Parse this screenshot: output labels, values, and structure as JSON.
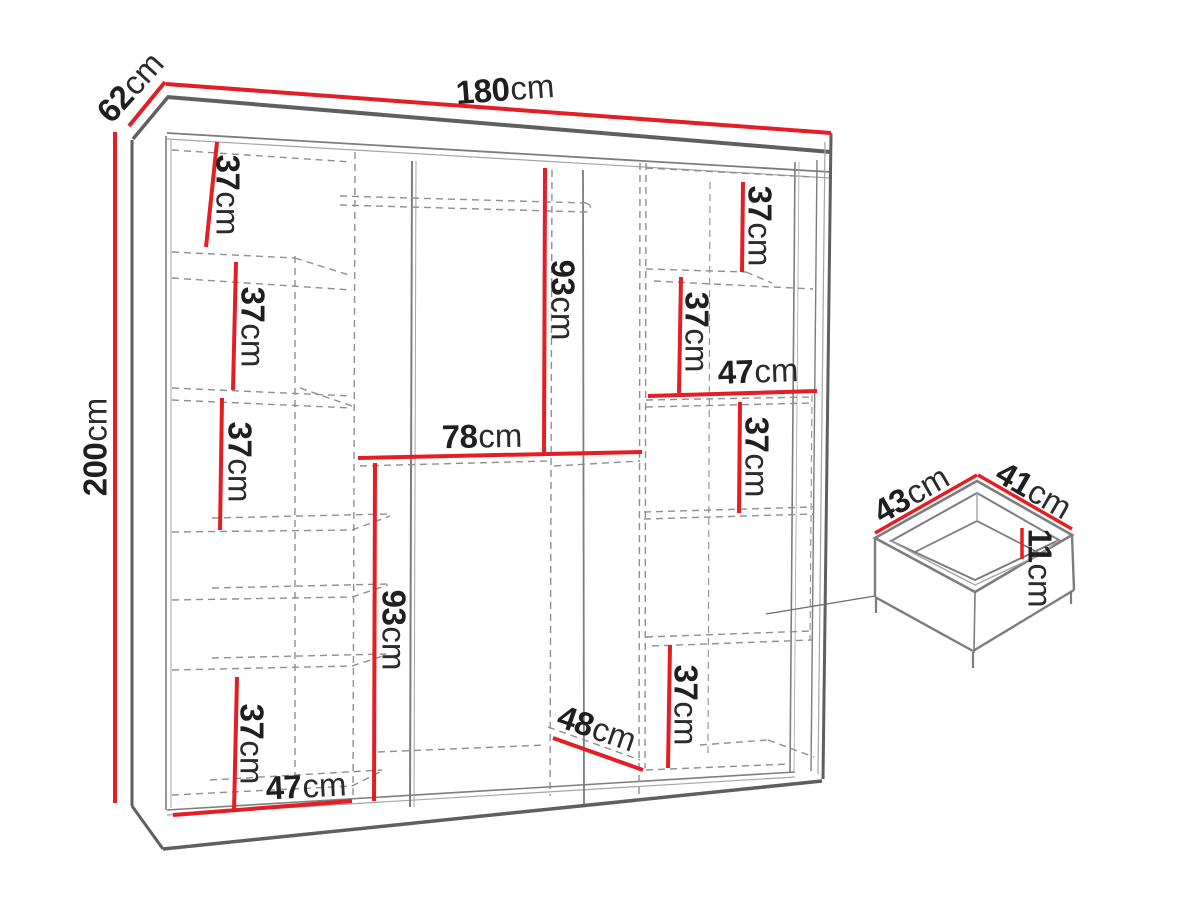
{
  "figure": {
    "kind": "wardrobe-dimension-diagram"
  },
  "colors": {
    "bg": "#ffffff",
    "dim_red": "#e31e25",
    "edge_dark": "#5f5f5f",
    "edge_mid": "#7d7d7d",
    "edge_light": "#a5a5a5",
    "dash_gray": "#8f8f8f",
    "leader_gray": "#6b6b6b",
    "label_color": "#1f1f1f"
  },
  "labels": {
    "w180": {
      "v": "180",
      "u": "cm"
    },
    "d62": {
      "v": "62",
      "u": "cm"
    },
    "h200": {
      "v": "200",
      "u": "cm"
    },
    "l37a": {
      "v": "37",
      "u": "cm"
    },
    "l37b": {
      "v": "37",
      "u": "cm"
    },
    "l37c": {
      "v": "37",
      "u": "cm"
    },
    "l37d": {
      "v": "37",
      "u": "cm"
    },
    "bl47": {
      "v": "47",
      "u": "cm"
    },
    "c93a": {
      "v": "93",
      "u": "cm"
    },
    "c78": {
      "v": "78",
      "u": "cm"
    },
    "c93b": {
      "v": "93",
      "u": "cm"
    },
    "c48": {
      "v": "48",
      "u": "cm"
    },
    "rb37": {
      "v": "37",
      "u": "cm"
    },
    "r37a": {
      "v": "37",
      "u": "cm"
    },
    "r37b": {
      "v": "37",
      "u": "cm"
    },
    "r47": {
      "v": "47",
      "u": "cm"
    },
    "r37c": {
      "v": "37",
      "u": "cm"
    },
    "dw43": {
      "v": "43",
      "u": "cm"
    },
    "dw41": {
      "v": "41",
      "u": "cm"
    },
    "dw11": {
      "v": "11",
      "u": "cm"
    }
  }
}
